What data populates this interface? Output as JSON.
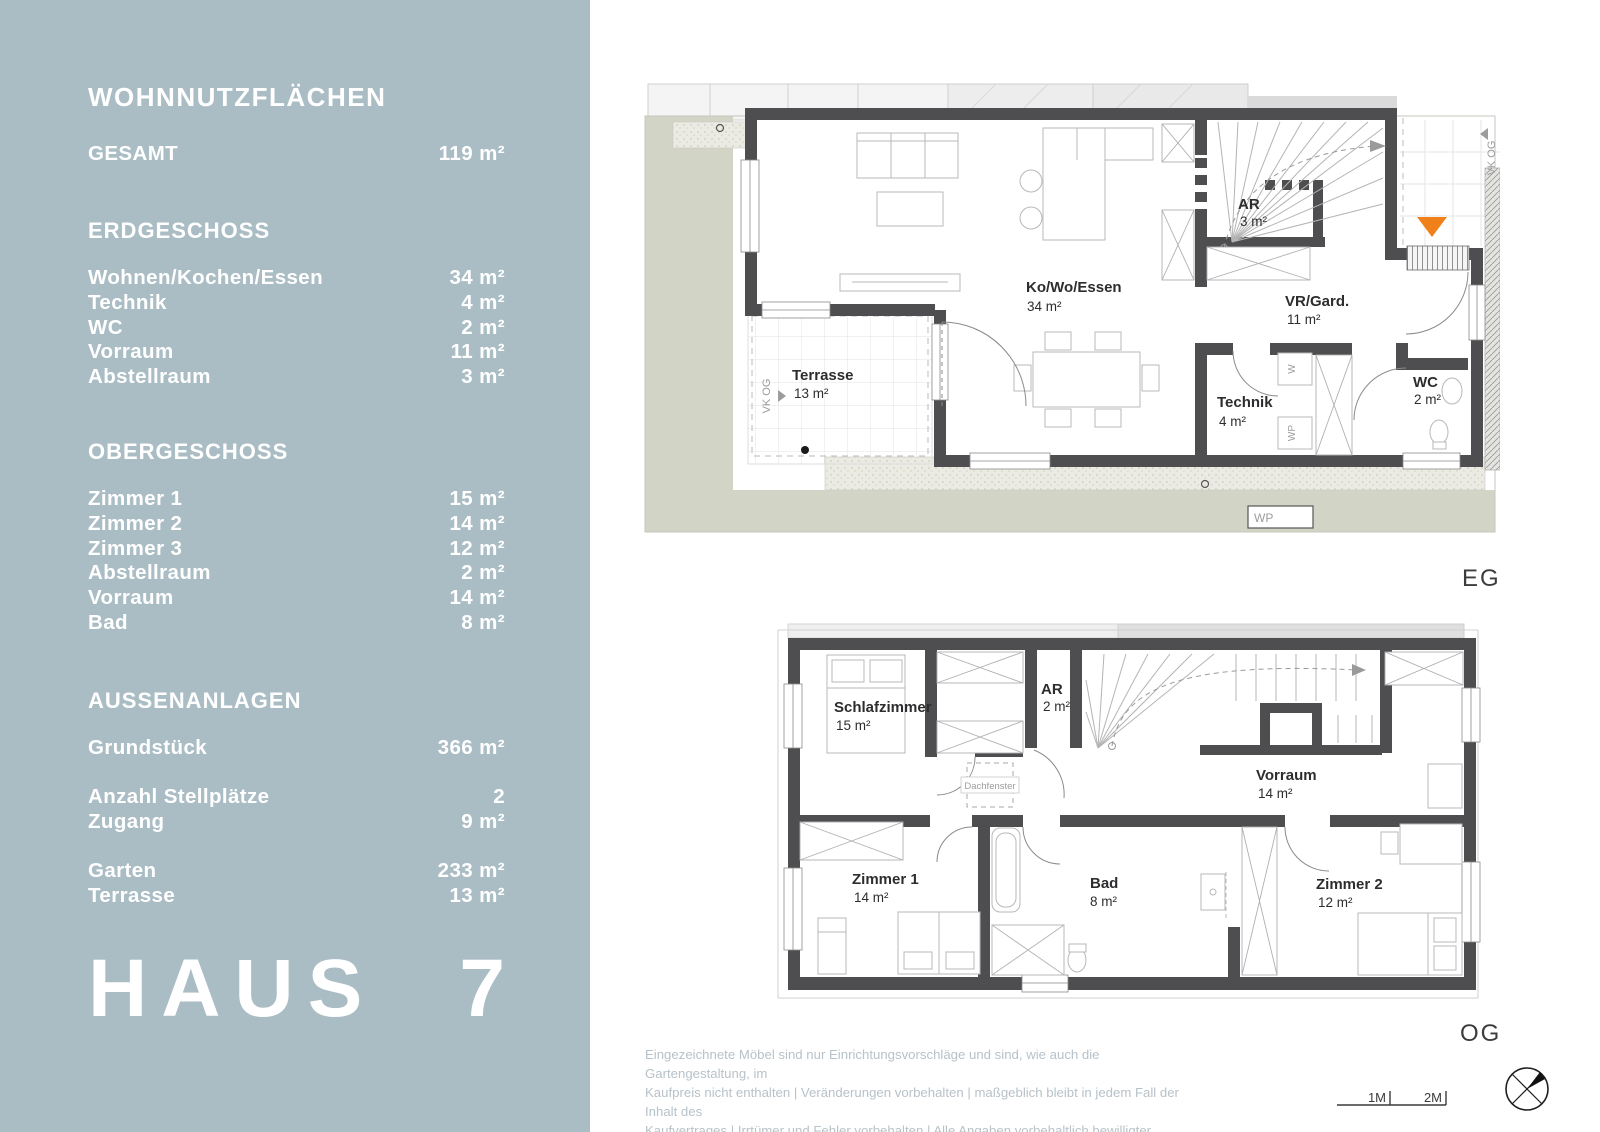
{
  "sidebar": {
    "title": "WOHNNUTZFLÄCHEN",
    "gesamt": {
      "label": "GESAMT",
      "value": "119 m²"
    },
    "eg": {
      "heading": "ERDGESCHOSS",
      "rows": [
        {
          "label": "Wohnen/Kochen/Essen",
          "value": "34 m²"
        },
        {
          "label": "Technik",
          "value": "4 m²"
        },
        {
          "label": "WC",
          "value": "2 m²"
        },
        {
          "label": "Vorraum",
          "value": "11 m²"
        },
        {
          "label": "Abstellraum",
          "value": "3 m²"
        }
      ]
    },
    "og": {
      "heading": "OBERGESCHOSS",
      "rows": [
        {
          "label": "Zimmer 1",
          "value": "15 m²"
        },
        {
          "label": "Zimmer 2",
          "value": "14 m²"
        },
        {
          "label": "Zimmer 3",
          "value": "12 m²"
        },
        {
          "label": "Abstellraum",
          "value": "2 m²"
        },
        {
          "label": "Vorraum",
          "value": "14 m²"
        },
        {
          "label": "Bad",
          "value": "8 m²"
        }
      ]
    },
    "aussen": {
      "heading": "AUSSENANLAGEN",
      "group1": [
        {
          "label": "Grundstück",
          "value": "366 m²"
        }
      ],
      "group2": [
        {
          "label": "Anzahl Stellplätze",
          "value": "2"
        },
        {
          "label": "Zugang",
          "value": "9 m²"
        }
      ],
      "group3": [
        {
          "label": "Garten",
          "value": "233 m²"
        },
        {
          "label": "Terrasse",
          "value": "13 m²"
        }
      ]
    },
    "house": {
      "name": "HAUS",
      "number": "7"
    }
  },
  "plan_eg": {
    "floor_label": "EG",
    "rooms": {
      "kowo": {
        "name": "Ko/Wo/Essen",
        "area": "34 m²"
      },
      "ar": {
        "name": "AR",
        "area": "3 m²"
      },
      "vr": {
        "name": "VR/Gard.",
        "area": "11 m²"
      },
      "technik": {
        "name": "Technik",
        "area": "4 m²"
      },
      "wc": {
        "name": "WC",
        "area": "2 m²"
      },
      "terrasse": {
        "name": "Terrasse",
        "area": "13 m²"
      }
    },
    "annotations": {
      "vk_og_left": "VK OG",
      "vk_og_right": "VK OG",
      "wp_box": "WP",
      "w_appliance": "W",
      "wp_appliance": "WP"
    }
  },
  "plan_og": {
    "floor_label": "OG",
    "rooms": {
      "schlafzimmer": {
        "name": "Schlafzimmer",
        "area": "15 m²"
      },
      "ar": {
        "name": "AR",
        "area": "2 m²"
      },
      "vorraum": {
        "name": "Vorraum",
        "area": "14 m²"
      },
      "zimmer1": {
        "name": "Zimmer 1",
        "area": "14 m²"
      },
      "bad": {
        "name": "Bad",
        "area": "8 m²"
      },
      "zimmer2": {
        "name": "Zimmer 2",
        "area": "12 m²"
      }
    },
    "annotations": {
      "dachfenster": "Dachfenster"
    }
  },
  "footer": {
    "disclaimer_lines": [
      "Eingezeichnete Möbel sind nur Einrichtungsvorschläge und sind, wie auch die Gartengestaltung, im",
      "Kaufpreis nicht enthalten | Veränderungen vorbehalten | maßgeblich bleibt in jedem Fall der Inhalt des",
      "Kaufvertrages | Irrtümer und Fehler vorbehalten | Alle Angaben vorbehaltlich bewilligter Einreichplanung"
    ],
    "scale_labels": {
      "m1": "1M",
      "m2": "2M"
    }
  },
  "colors": {
    "sidebar_bg": "#aabdc5",
    "accent_orange": "#f08019",
    "wall": "#4e4e51",
    "garden": "#d2d5c5"
  }
}
